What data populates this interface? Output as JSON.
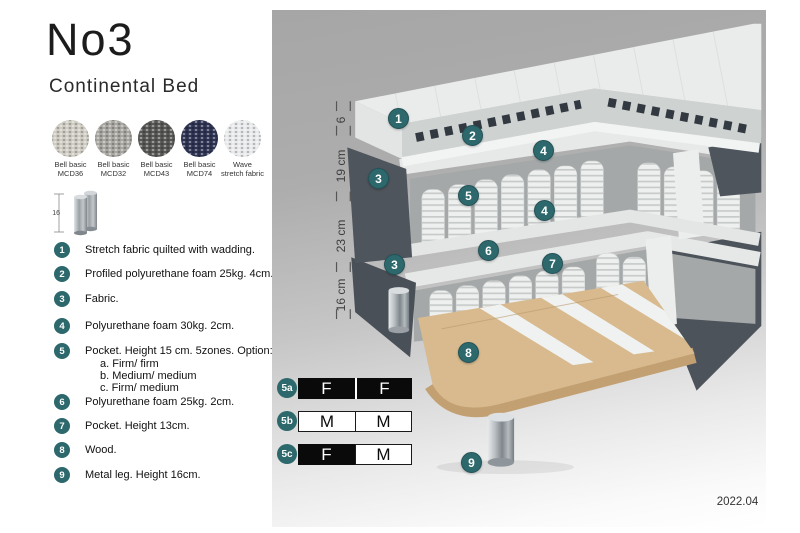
{
  "header": {
    "title": "No3",
    "subtitle": "Continental Bed"
  },
  "swatches": [
    {
      "name": "Bell basic",
      "code": "MCD36",
      "color": "#cfccc3"
    },
    {
      "name": "Bell basic",
      "code": "MCD32",
      "color": "#a8a6a1"
    },
    {
      "name": "Bell basic",
      "code": "MCD43",
      "color": "#575755"
    },
    {
      "name": "Bell basic",
      "code": "MCD74",
      "color": "#2e3352"
    },
    {
      "name": "Wave",
      "code": "stretch fabric",
      "color": "#e9eaec"
    }
  ],
  "leg_icon": {
    "height_label": "16"
  },
  "legend": [
    {
      "num": "1",
      "text": "Stretch fabric quilted with wadding."
    },
    {
      "num": "2",
      "text": "Profiled polyurethane foam 25kg. 4cm."
    },
    {
      "num": "3",
      "text": "Fabric."
    },
    {
      "num": "4",
      "text": "Polyurethane foam 30kg. 2cm."
    },
    {
      "num": "5",
      "text": "Pocket. Height 15 cm. 5zones. Option:",
      "options": [
        "a. Firm/ firm",
        "b. Medium/ medium",
        "c. Firm/ medium"
      ]
    },
    {
      "num": "6",
      "text": "Polyurethane foam 25kg. 2cm."
    },
    {
      "num": "7",
      "text": "Pocket. Height 13cm."
    },
    {
      "num": "8",
      "text": "Wood."
    },
    {
      "num": "9",
      "text": "Metal leg. Height 16cm."
    }
  ],
  "diagram": {
    "dimensions": [
      "6",
      "19 cm",
      "23 cm",
      "16 cm"
    ],
    "callouts": [
      {
        "num": "1"
      },
      {
        "num": "2"
      },
      {
        "num": "4"
      },
      {
        "num": "3"
      },
      {
        "num": "5"
      },
      {
        "num": "4"
      },
      {
        "num": "6"
      },
      {
        "num": "7"
      },
      {
        "num": "3"
      },
      {
        "num": "8"
      },
      {
        "num": "9"
      }
    ]
  },
  "firmness_table": {
    "rows": [
      {
        "label": "5a",
        "cells": [
          {
            "text": "F",
            "filled": true
          },
          {
            "text": "F",
            "filled": true
          }
        ]
      },
      {
        "label": "5b",
        "cells": [
          {
            "text": "M",
            "filled": false
          },
          {
            "text": "M",
            "filled": false
          }
        ]
      },
      {
        "label": "5c",
        "cells": [
          {
            "text": "F",
            "filled": true
          },
          {
            "text": "M",
            "filled": false
          }
        ]
      }
    ]
  },
  "footer": {
    "version_date": "2022.04"
  },
  "colors": {
    "accent_teal": "#2c686c",
    "fabric_dark_gray": "#4f555d",
    "wood": "#d8ba8e",
    "chrome_leg": "#aab0b4",
    "panel_gray": "#a6a6a6"
  }
}
